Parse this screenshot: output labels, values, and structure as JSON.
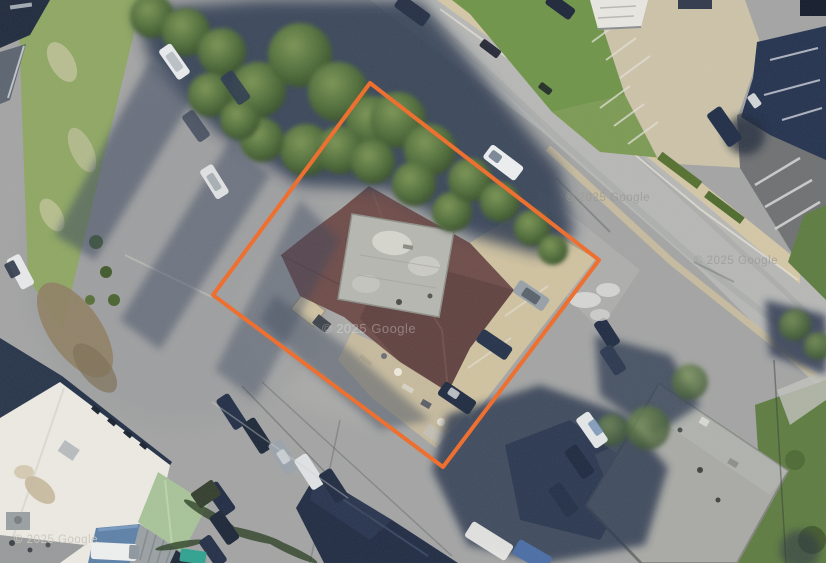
{
  "map": {
    "kind": "satellite-aerial-view",
    "provider": "Google"
  },
  "watermarks": {
    "center": "© 2025 Google",
    "road_upper": "© 2025 Google",
    "road_lower": "© 2025 Google",
    "bottom_left": "© 2025 Google"
  },
  "boundary": {
    "label": "property-boundary-outline",
    "color": "#ED7031",
    "stroke_width": 4,
    "points": "370,83 599,260 443,467 213,295"
  },
  "colors": {
    "boundary_orange": "#ED7031",
    "asphalt": "#a3a4a3",
    "road": "#b7b8b6",
    "sidewalk_tan": "#d3c7a6",
    "grass": "#6f9448",
    "tree_shadow": "#2c3950",
    "house_roof_maroon": "#6e4c49",
    "flat_roof_gray": "#b7b7b1",
    "white_roof": "#eceae2",
    "green_roof": "#a8c399",
    "blue_roof": "#5d81a8",
    "navy_roof": "#24324e",
    "gray_roof": "#a9aaa5"
  }
}
